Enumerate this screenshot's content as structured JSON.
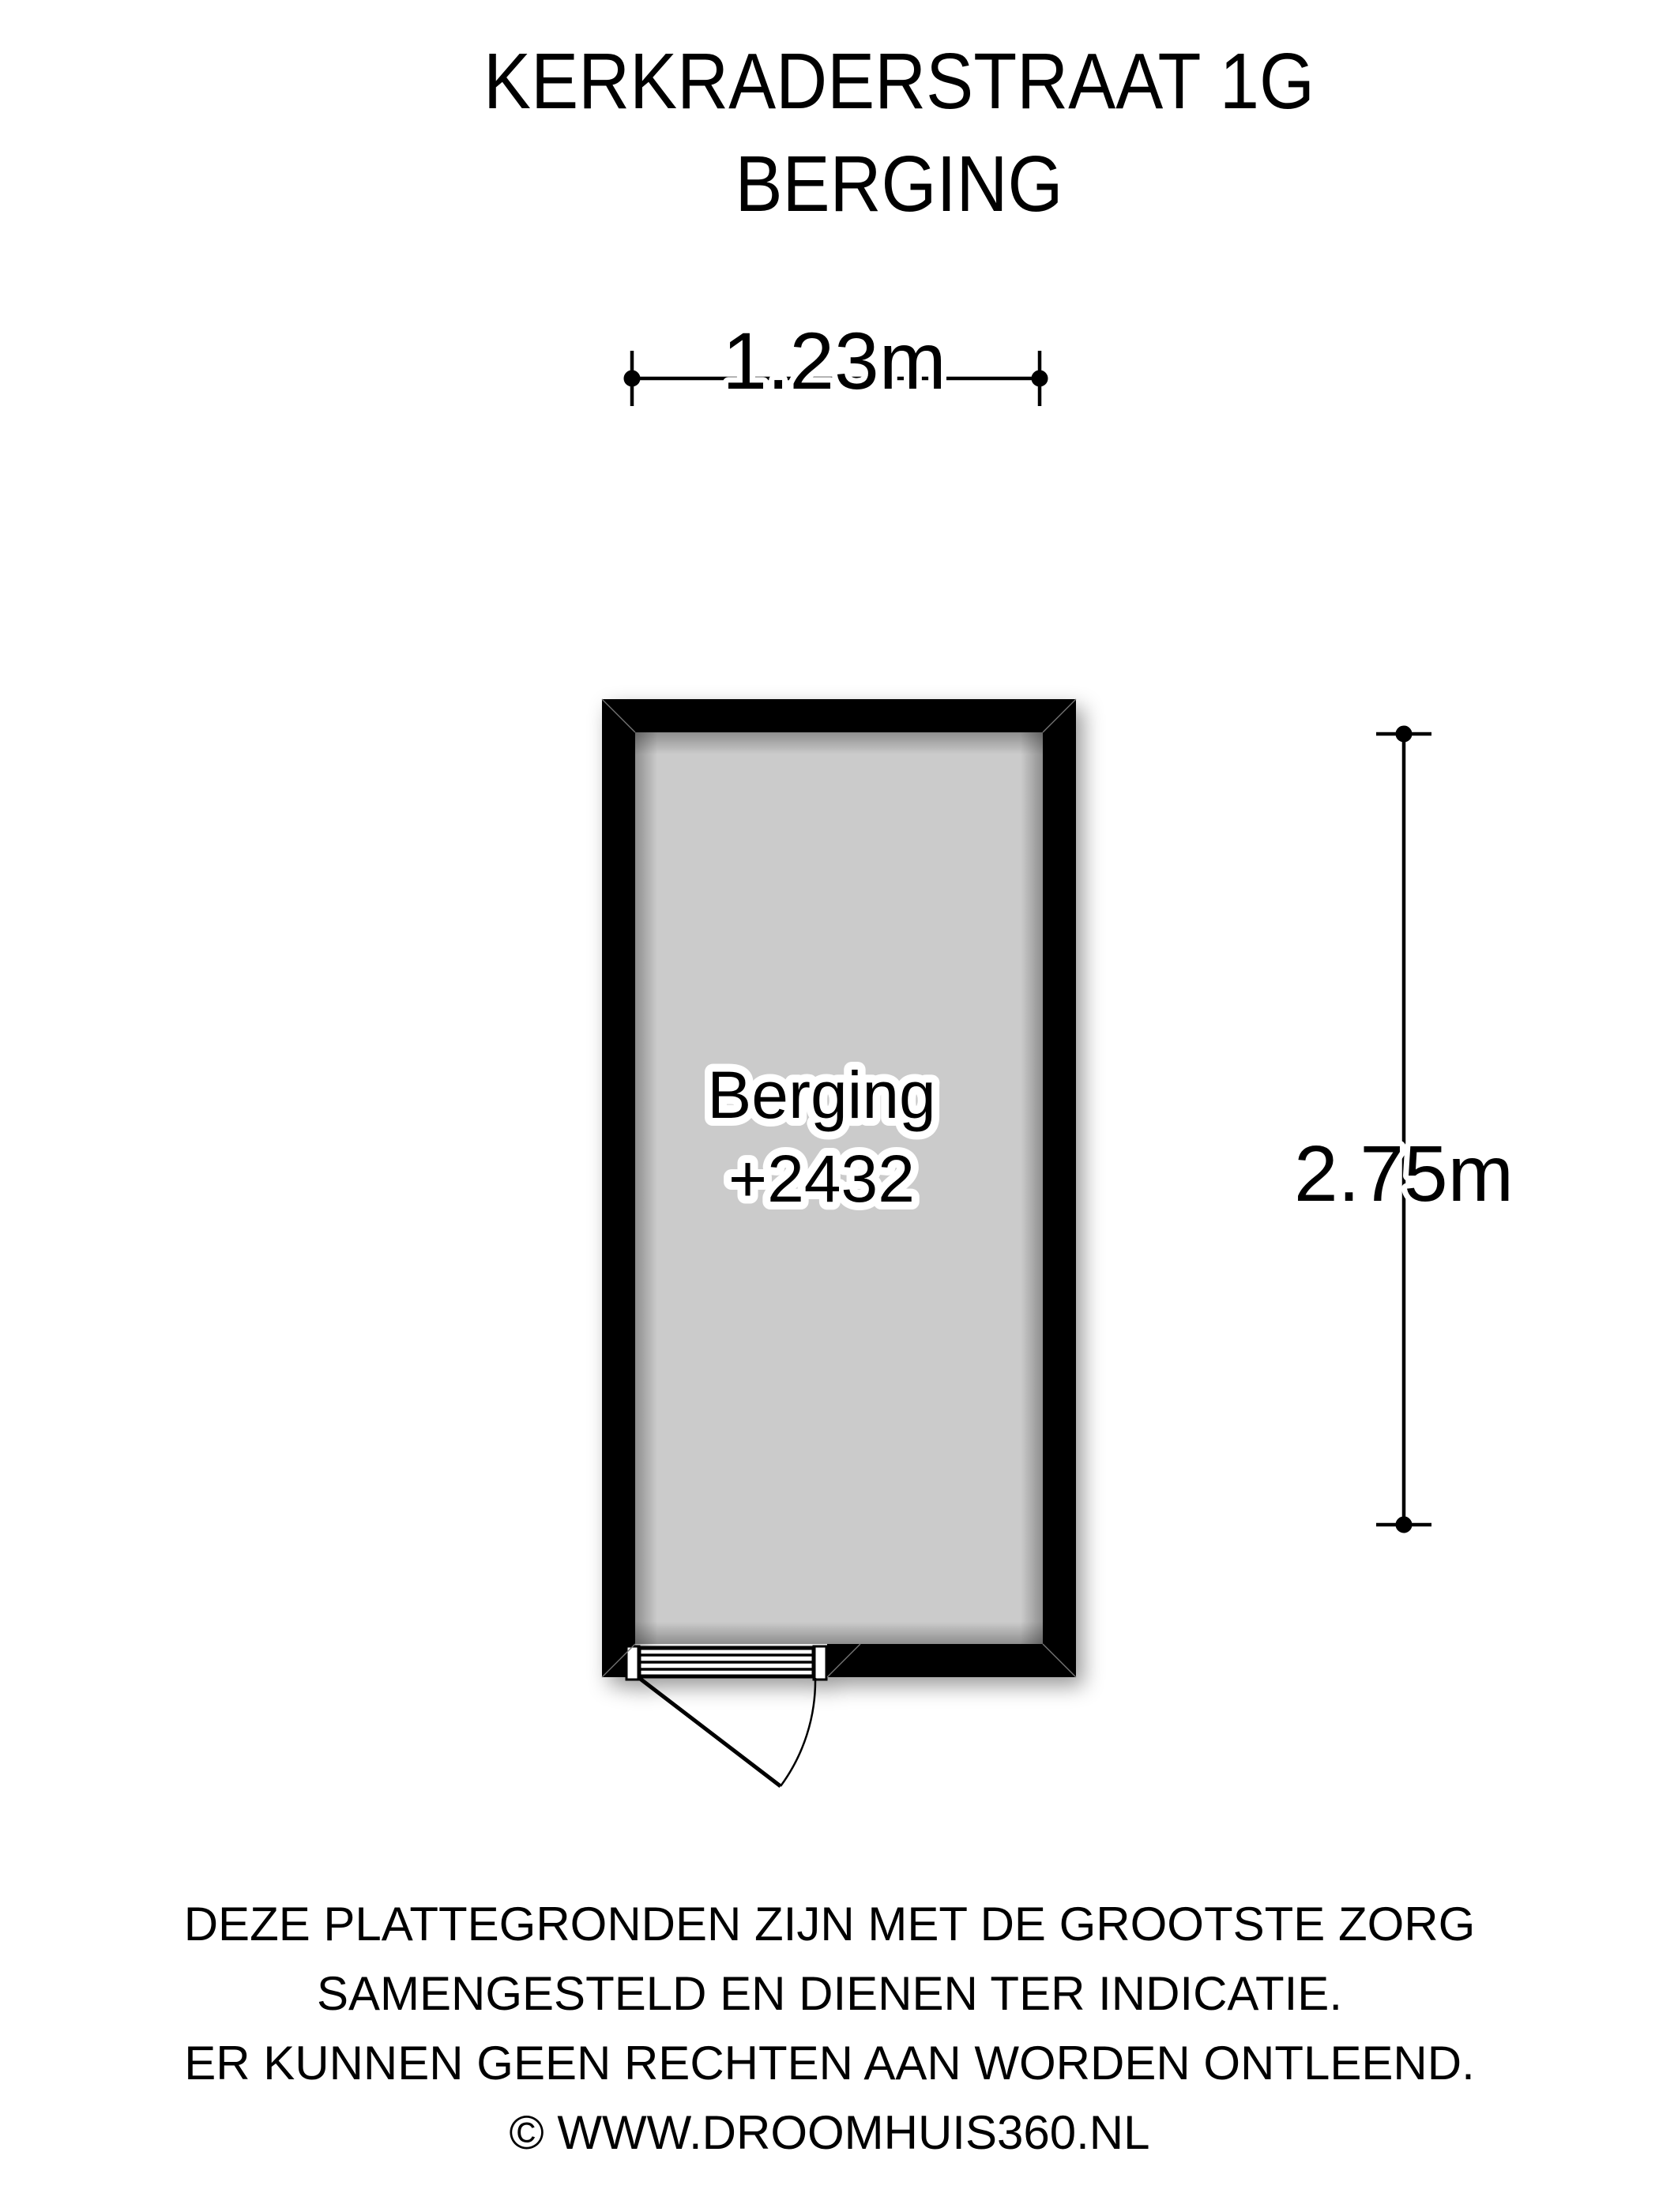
{
  "header": {
    "address": "KERKRADERSTRAAT 1G",
    "subtitle": "BERGING"
  },
  "floorplan": {
    "room_label": "Berging",
    "room_code": "+2432",
    "width_dimension": "1.23m",
    "height_dimension": "2.75m",
    "room_fill_color": "#cbcbcb",
    "wall_color": "#000000"
  },
  "footer": {
    "lines": [
      "DEZE PLATTEGRONDEN ZIJN MET DE GROOTSTE ZORG",
      "SAMENGESTELD EN DIENEN TER INDICATIE.",
      "ER KUNNEN GEEN RECHTEN AAN WORDEN ONTLEEND.",
      "© WWW.DROOMHUIS360.NL"
    ]
  }
}
